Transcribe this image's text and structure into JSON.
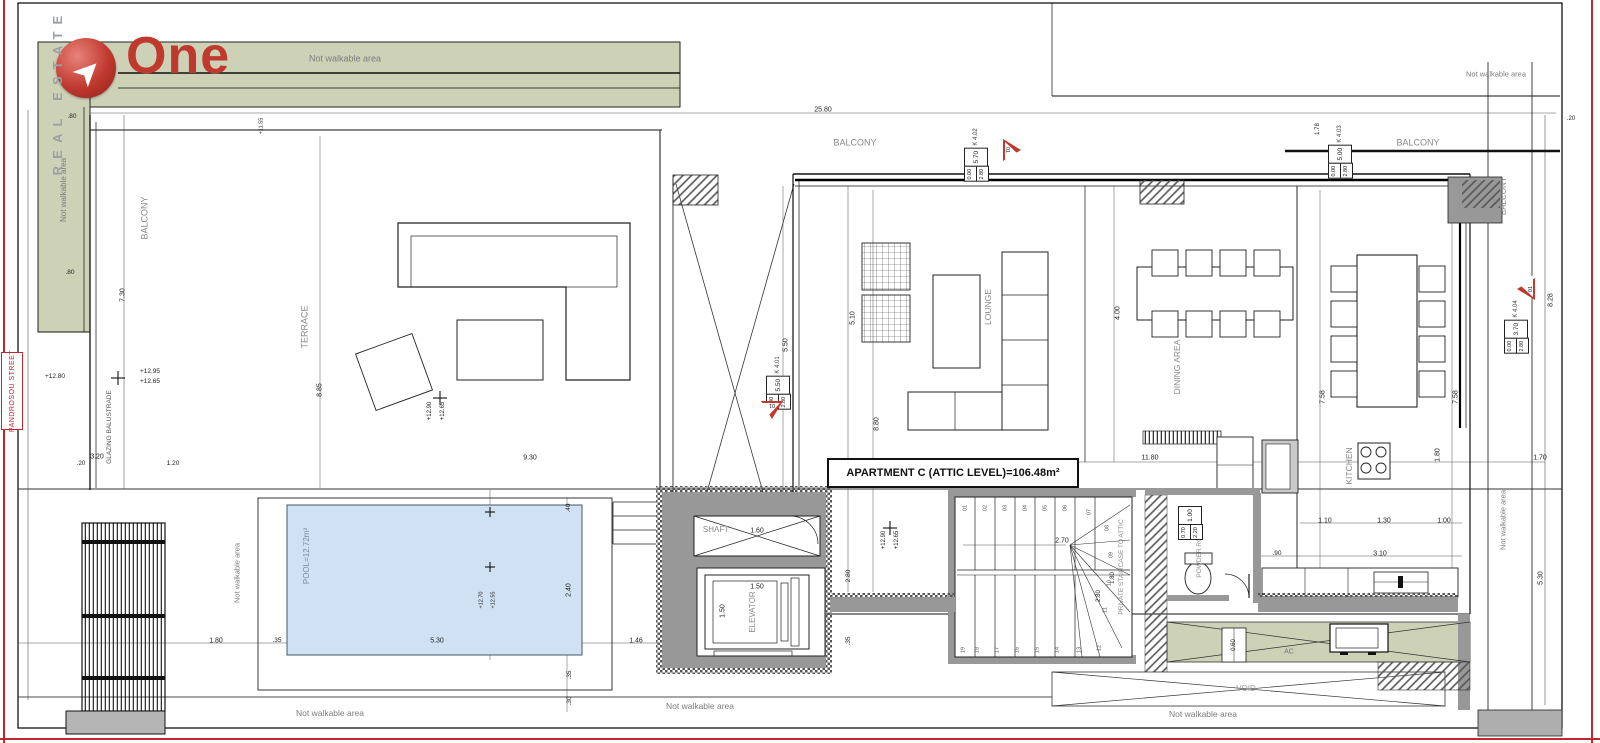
{
  "colors": {
    "accent_red": "#c0392f",
    "area_green": "#cdd1b6",
    "pool_blue": "#cfe1f2",
    "wall_gray": "#989898"
  },
  "logo": {
    "title": "One",
    "subtitle": "REAL ESTATE"
  },
  "street": "PANDROSOU STREET",
  "apartment_area_label": "APARTMENT C (ATTIC LEVEL)=106.48m²",
  "window_tags": [
    {
      "id": "K 4.01",
      "main": "5.50",
      "a": "0.00",
      "b": "2.80",
      "x": 778,
      "y": 383
    },
    {
      "id": "K 4.02",
      "main": "5.70",
      "a": "0.00",
      "b": "2.80",
      "x": 976,
      "y": 155
    },
    {
      "id": "K 4.03",
      "main": "5.00",
      "a": "0.00",
      "b": "2.80",
      "x": 1340,
      "y": 152
    },
    {
      "id": "K 4.04",
      "main": "3.70",
      "a": "0.00",
      "b": "2.80",
      "x": 1516,
      "y": 327
    },
    {
      "id": "",
      "main": "1.00",
      "a": "0.70",
      "b": "2.20",
      "x": 1190,
      "y": 522
    }
  ],
  "triangles": [
    {
      "t": "01",
      "x": 772,
      "y": 410,
      "dir": "down"
    },
    {
      "t": "01",
      "x": 1012,
      "y": 150,
      "dir": "right"
    },
    {
      "t": "01",
      "x": 1526,
      "y": 289,
      "dir": "left"
    }
  ],
  "texts": [
    {
      "n": "not-walkable-label",
      "t": "Not walkable area",
      "x": 345,
      "y": 59,
      "s": 9,
      "c": "#7d7d7d"
    },
    {
      "n": "not-walkable-label",
      "t": "Not walkable area",
      "x": 64,
      "y": 190,
      "r": -90,
      "s": 8,
      "c": "#7d7d7d"
    },
    {
      "n": "not-walkable-label",
      "t": "Not walkable area",
      "x": 1496,
      "y": 74,
      "s": 7.5,
      "c": "#7d7d7d"
    },
    {
      "n": "not-walkable-label",
      "t": "Not walkable area",
      "x": 237,
      "y": 573,
      "r": -90,
      "s": 7.5,
      "c": "#7d7d7d"
    },
    {
      "n": "not-walkable-label",
      "t": "Not walkable area",
      "x": 330,
      "y": 713,
      "s": 8.5,
      "c": "#7d7d7d"
    },
    {
      "n": "not-walkable-label",
      "t": "Not walkable area",
      "x": 700,
      "y": 706,
      "s": 8.5,
      "c": "#7d7d7d"
    },
    {
      "n": "not-walkable-label",
      "t": "Not walkable area",
      "x": 1203,
      "y": 714,
      "s": 8.5,
      "c": "#7d7d7d"
    },
    {
      "n": "not-walkable-label",
      "t": "Not walkable area",
      "x": 1503,
      "y": 520,
      "r": -90,
      "s": 7.5,
      "c": "#7d7d7d"
    },
    {
      "n": "glazing-balustrade-label",
      "t": "GLAZING BALUSTRADE",
      "x": 110,
      "y": 427,
      "r": -90,
      "s": 6.5,
      "c": "#555555"
    },
    {
      "n": "room-label-balcony",
      "t": "BALCONY",
      "x": 145,
      "y": 218,
      "r": -90,
      "s": 9,
      "c": "#8a8a8a"
    },
    {
      "n": "room-label-terrace",
      "t": "TERRACE",
      "x": 305,
      "y": 327,
      "r": -90,
      "s": 9,
      "c": "#8a8a8a"
    },
    {
      "n": "room-label-balcony",
      "t": "BALCONY",
      "x": 855,
      "y": 143,
      "s": 9,
      "c": "#8a8a8a"
    },
    {
      "n": "room-label-balcony",
      "t": "BALCONY",
      "x": 1418,
      "y": 143,
      "s": 9,
      "c": "#8a8a8a"
    },
    {
      "n": "room-label-balcony",
      "t": "BALCONY",
      "x": 1504,
      "y": 196,
      "r": -90,
      "s": 8,
      "c": "#8a8a8a"
    },
    {
      "n": "room-label-lounge",
      "t": "LOUNGE",
      "x": 988,
      "y": 307,
      "r": -90,
      "s": 8.5,
      "c": "#8a8a8a"
    },
    {
      "n": "room-label-dining",
      "t": "DINING AREA",
      "x": 1177,
      "y": 367,
      "r": -90,
      "s": 8.5,
      "c": "#8a8a8a"
    },
    {
      "n": "room-label-kitchen",
      "t": "KITCHEN",
      "x": 1349,
      "y": 466,
      "r": -90,
      "s": 8.5,
      "c": "#8a8a8a"
    },
    {
      "n": "room-label-shaft",
      "t": "SHAFT",
      "x": 716,
      "y": 530,
      "s": 8,
      "c": "#8a8a8a"
    },
    {
      "n": "room-label-elevator",
      "t": "ELEVATOR",
      "x": 753,
      "y": 612,
      "r": -90,
      "s": 8,
      "c": "#8a8a8a"
    },
    {
      "n": "room-label-powder",
      "t": "POWDER ROOM",
      "x": 1200,
      "y": 552,
      "r": -90,
      "s": 6.5,
      "c": "#8a8a8a"
    },
    {
      "n": "room-label-staircase",
      "t": "PRIVATE STAIRCASE TO ATTIC",
      "x": 1122,
      "y": 567,
      "r": -90,
      "s": 6.5,
      "c": "#8a8a8a"
    },
    {
      "n": "room-label-pool",
      "t": "POOL=12.72m²",
      "x": 307,
      "y": 556,
      "r": -90,
      "s": 8,
      "c": "#7a8aa0"
    },
    {
      "n": "room-label-void",
      "t": "VOID",
      "x": 1246,
      "y": 689,
      "s": 8,
      "c": "#999999"
    },
    {
      "n": "room-label-ac",
      "t": "AC",
      "x": 1289,
      "y": 652,
      "s": 7,
      "c": "#777777"
    },
    {
      "n": "dim-label",
      "t": "25.80",
      "x": 823,
      "y": 110
    },
    {
      "n": "dim-label",
      "t": ".80",
      "x": 72,
      "y": 117,
      "s": 6.5
    },
    {
      "n": "dim-label",
      "t": ".80",
      "x": 70,
      "y": 273,
      "s": 6.5
    },
    {
      "n": "dim-label",
      "t": "7.30",
      "x": 123,
      "y": 295,
      "r": -90
    },
    {
      "n": "dim-label",
      "t": "3.20",
      "x": 97,
      "y": 457
    },
    {
      "n": "dim-label",
      "t": "9.30",
      "x": 530,
      "y": 458
    },
    {
      "n": "dim-label",
      "t": "8.85",
      "x": 320,
      "y": 390,
      "r": -90
    },
    {
      "n": "dim-label",
      "t": "5.50",
      "x": 786,
      "y": 345,
      "r": -90
    },
    {
      "n": "dim-label",
      "t": "5.10",
      "x": 853,
      "y": 318,
      "r": -90
    },
    {
      "n": "dim-label",
      "t": "8.80",
      "x": 877,
      "y": 424,
      "r": -90
    },
    {
      "n": "dim-label",
      "t": "4.00",
      "x": 1118,
      "y": 313,
      "r": -90
    },
    {
      "n": "dim-label",
      "t": "7.58",
      "x": 1323,
      "y": 397,
      "r": -90
    },
    {
      "n": "dim-label",
      "t": "7.58",
      "x": 1456,
      "y": 397,
      "r": -90
    },
    {
      "n": "dim-label",
      "t": "11.80",
      "x": 1150,
      "y": 458
    },
    {
      "n": "dim-label",
      "t": "2.70",
      "x": 1062,
      "y": 541
    },
    {
      "n": "dim-label",
      "t": "1.80",
      "x": 1113,
      "y": 578,
      "r": -90,
      "s": 6
    },
    {
      "n": "dim-label",
      "t": "2.80",
      "x": 1099,
      "y": 596,
      "r": -90,
      "s": 6
    },
    {
      "n": "dim-label",
      "t": "1.60",
      "x": 757,
      "y": 531
    },
    {
      "n": "dim-label",
      "t": "1.50",
      "x": 757,
      "y": 587
    },
    {
      "n": "dim-label",
      "t": "1.50",
      "x": 723,
      "y": 611,
      "r": -90
    },
    {
      "n": "dim-label",
      "t": "2.80",
      "x": 849,
      "y": 576,
      "r": -90,
      "s": 6.5
    },
    {
      "n": "dim-label",
      "t": ".35",
      "x": 849,
      "y": 641,
      "r": -90,
      "s": 6.5
    },
    {
      "n": "dim-label",
      "t": ".40",
      "x": 569,
      "y": 508,
      "r": -90,
      "s": 6.5
    },
    {
      "n": "dim-label",
      "t": "2.40",
      "x": 569,
      "y": 590,
      "r": -90
    },
    {
      "n": "dim-label",
      "t": ".35",
      "x": 570,
      "y": 675,
      "r": -90,
      "s": 6.5
    },
    {
      "n": "dim-label",
      "t": ".30",
      "x": 570,
      "y": 701,
      "r": -90,
      "s": 6.5
    },
    {
      "n": "dim-label",
      "t": "1.46",
      "x": 636,
      "y": 641
    },
    {
      "n": "dim-label",
      "t": "5.30",
      "x": 437,
      "y": 641
    },
    {
      "n": "dim-label",
      "t": "1.80",
      "x": 216,
      "y": 641
    },
    {
      "n": "dim-label",
      "t": ".35",
      "x": 277,
      "y": 641,
      "s": 6.5
    },
    {
      "n": "dim-label",
      "t": "1.10",
      "x": 1325,
      "y": 521
    },
    {
      "n": "dim-label",
      "t": "1.30",
      "x": 1384,
      "y": 521
    },
    {
      "n": "dim-label",
      "t": "1.00",
      "x": 1444,
      "y": 521
    },
    {
      "n": "dim-label",
      "t": ".90",
      "x": 1277,
      "y": 554,
      "s": 6.5
    },
    {
      "n": "dim-label",
      "t": "3.10",
      "x": 1380,
      "y": 554
    },
    {
      "n": "dim-label",
      "t": "1.80",
      "x": 1438,
      "y": 455,
      "r": -90
    },
    {
      "n": "dim-label",
      "t": "1.70",
      "x": 1540,
      "y": 458
    },
    {
      "n": "dim-label",
      "t": "8.28",
      "x": 1551,
      "y": 300,
      "r": -90
    },
    {
      "n": "dim-label",
      "t": "5.30",
      "x": 1541,
      "y": 578,
      "r": -90
    },
    {
      "n": "dim-label",
      "t": "1.78",
      "x": 1318,
      "y": 129,
      "r": -90,
      "s": 6
    },
    {
      "n": "dim-label",
      "t": ".20",
      "x": 1571,
      "y": 119,
      "s": 6
    },
    {
      "n": "dim-label",
      "t": ".20",
      "x": 81,
      "y": 464,
      "s": 6
    },
    {
      "n": "dim-label",
      "t": "1.20",
      "x": 173,
      "y": 464,
      "s": 6.5
    },
    {
      "n": "dim-label",
      "t": "0.60",
      "x": 1234,
      "y": 645,
      "r": -90,
      "s": 6
    },
    {
      "n": "level-label",
      "t": "+12.80",
      "x": 55,
      "y": 377,
      "s": 6.5
    },
    {
      "n": "level-label",
      "t": "+12.95",
      "x": 150,
      "y": 372,
      "s": 6.5
    },
    {
      "n": "level-label",
      "t": "+12.65",
      "x": 150,
      "y": 382,
      "s": 6.5
    },
    {
      "n": "level-label",
      "t": "+12.90",
      "x": 430,
      "y": 411,
      "r": -90,
      "s": 6
    },
    {
      "n": "level-label",
      "t": "+12.65",
      "x": 443,
      "y": 411,
      "r": -90,
      "s": 6
    },
    {
      "n": "level-label",
      "t": "+12.90",
      "x": 884,
      "y": 540,
      "r": -90,
      "s": 6
    },
    {
      "n": "level-label",
      "t": "+12.65",
      "x": 897,
      "y": 540,
      "r": -90,
      "s": 6
    },
    {
      "n": "level-label",
      "t": "+11.55",
      "x": 262,
      "y": 126,
      "r": -90,
      "s": 5.5
    },
    {
      "n": "level-label",
      "t": "+12.70",
      "x": 482,
      "y": 600,
      "r": -90,
      "s": 5.5
    },
    {
      "n": "level-label",
      "t": "+12.55",
      "x": 494,
      "y": 600,
      "r": -90,
      "s": 5.5
    },
    {
      "n": "stair-step-number",
      "t": "01",
      "x": 966,
      "y": 508,
      "r": -90,
      "s": 5.5,
      "c": "#555555"
    },
    {
      "n": "stair-step-number",
      "t": "02",
      "x": 986,
      "y": 508,
      "r": -90,
      "s": 5.5,
      "c": "#555555"
    },
    {
      "n": "stair-step-number",
      "t": "03",
      "x": 1006,
      "y": 508,
      "r": -90,
      "s": 5.5,
      "c": "#555555"
    },
    {
      "n": "stair-step-number",
      "t": "04",
      "x": 1026,
      "y": 508,
      "r": -90,
      "s": 5.5,
      "c": "#555555"
    },
    {
      "n": "stair-step-number",
      "t": "05",
      "x": 1046,
      "y": 508,
      "r": -90,
      "s": 5.5,
      "c": "#555555"
    },
    {
      "n": "stair-step-number",
      "t": "06",
      "x": 1066,
      "y": 508,
      "r": -90,
      "s": 5.5,
      "c": "#555555"
    },
    {
      "n": "stair-step-number",
      "t": "07",
      "x": 1090,
      "y": 512,
      "r": -90,
      "s": 5.5,
      "c": "#555555"
    },
    {
      "n": "stair-step-number",
      "t": "08",
      "x": 1108,
      "y": 528,
      "r": -90,
      "s": 5.5,
      "c": "#555555"
    },
    {
      "n": "stair-step-number",
      "t": "09",
      "x": 1112,
      "y": 555,
      "r": -90,
      "s": 5.5,
      "c": "#555555"
    },
    {
      "n": "stair-step-number",
      "t": "10",
      "x": 1110,
      "y": 583,
      "r": -90,
      "s": 5.5,
      "c": "#555555"
    },
    {
      "n": "stair-step-number",
      "t": "11",
      "x": 1106,
      "y": 610,
      "r": -90,
      "s": 5.5,
      "c": "#555555"
    },
    {
      "n": "stair-step-number",
      "t": "12",
      "x": 1100,
      "y": 648,
      "r": -90,
      "s": 5.5,
      "c": "#555555"
    },
    {
      "n": "stair-step-number",
      "t": "13",
      "x": 1080,
      "y": 650,
      "r": -90,
      "s": 5.5,
      "c": "#555555"
    },
    {
      "n": "stair-step-number",
      "t": "14",
      "x": 1058,
      "y": 650,
      "r": -90,
      "s": 5.5,
      "c": "#555555"
    },
    {
      "n": "stair-step-number",
      "t": "15",
      "x": 1038,
      "y": 650,
      "r": -90,
      "s": 5.5,
      "c": "#555555"
    },
    {
      "n": "stair-step-number",
      "t": "16",
      "x": 1018,
      "y": 650,
      "r": -90,
      "s": 5.5,
      "c": "#555555"
    },
    {
      "n": "stair-step-number",
      "t": "17",
      "x": 998,
      "y": 650,
      "r": -90,
      "s": 5.5,
      "c": "#555555"
    },
    {
      "n": "stair-step-number",
      "t": "18",
      "x": 978,
      "y": 650,
      "r": -90,
      "s": 5.5,
      "c": "#555555"
    },
    {
      "n": "stair-step-number",
      "t": "19",
      "x": 964,
      "y": 650,
      "r": -90,
      "s": 5.5,
      "c": "#555555"
    }
  ]
}
